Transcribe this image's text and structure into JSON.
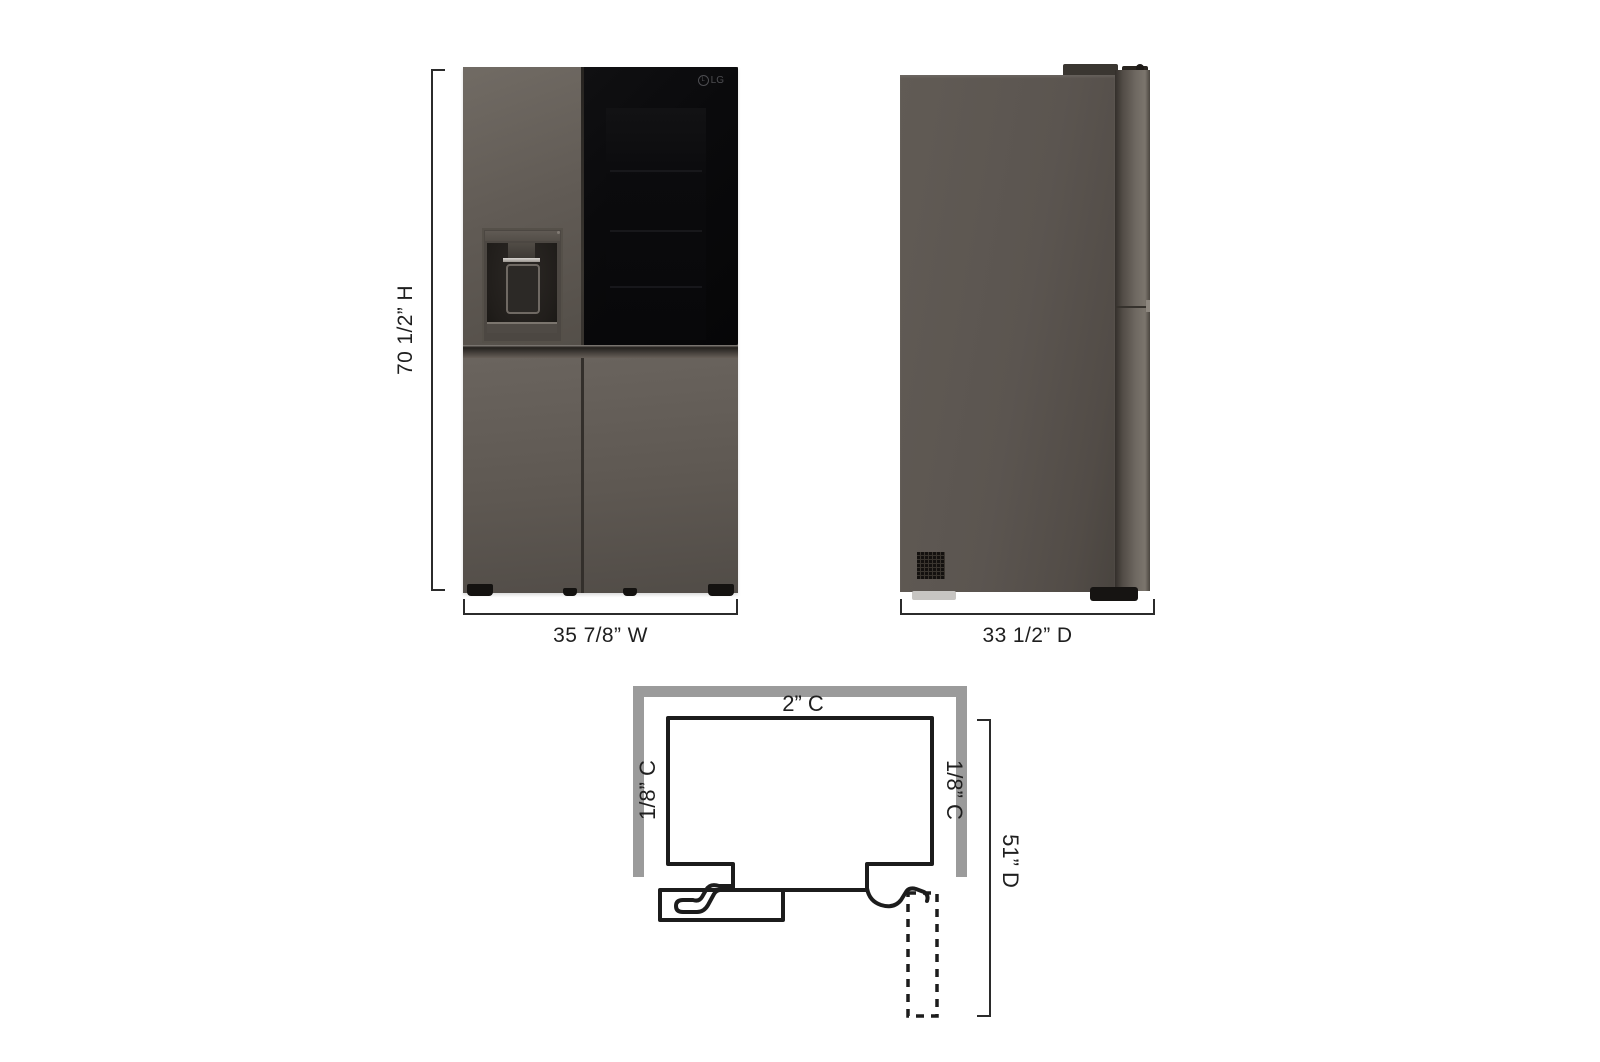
{
  "page": {
    "description": "Refrigerator product dimension diagram with front view, side view and top-down clearance drawing",
    "background_color": "#ffffff"
  },
  "front_view": {
    "height_label": "70 1/2” H",
    "width_label": "35 7/8” W",
    "brand_logo": "LG"
  },
  "side_view": {
    "depth_label": "33 1/2” D"
  },
  "clearance_diagram": {
    "top_clearance_label": "2” C",
    "left_clearance_label": "1/8” C",
    "right_clearance_label": "1/8” C",
    "open_depth_label": "51” D",
    "wall_color": "#9b9b9b",
    "outline_color": "#1c1c1c"
  },
  "colors": {
    "body_gray": "#5b5550",
    "glass_black": "#0a0a0c",
    "dimension_line": "#2b2b2b",
    "dimension_text": "#1f1f1f"
  }
}
